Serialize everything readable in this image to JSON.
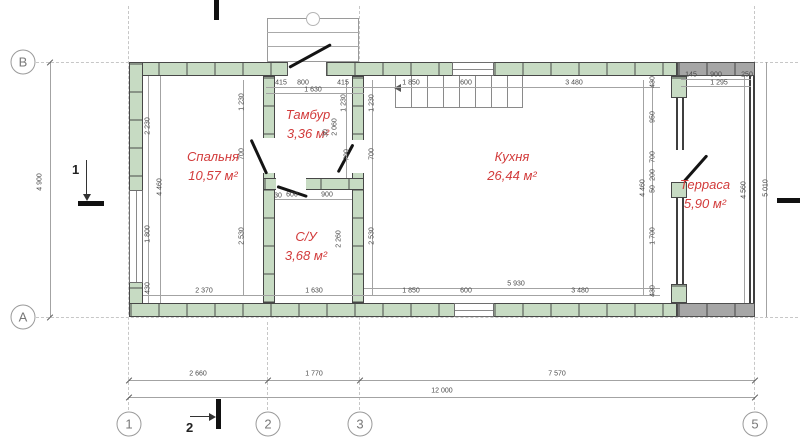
{
  "colors": {
    "wall_fill": "#c7dbc3",
    "terrace_wall_fill": "#a6a6a6",
    "wall_outline": "#474747",
    "room_label": "#d23b3b",
    "dimension_text": "#4a4a4a",
    "grid_line": "#c7c7c7"
  },
  "rooms": [
    {
      "id": "bedroom",
      "name": "Спальня",
      "area": "10,57 м²",
      "x": 213,
      "y": 148
    },
    {
      "id": "vestibule",
      "name": "Тамбур",
      "area": "3,36 м²",
      "x": 308,
      "y": 106
    },
    {
      "id": "bathroom",
      "name": "С/У",
      "area": "3,68 м²",
      "x": 306,
      "y": 228
    },
    {
      "id": "kitchen",
      "name": "Кухня",
      "area": "26,44 м²",
      "x": 512,
      "y": 148
    },
    {
      "id": "terrace",
      "name": "Терраса",
      "area": "5,90 м²",
      "x": 705,
      "y": 176
    }
  ],
  "grid": {
    "columns": [
      {
        "label": "1",
        "x": 129,
        "y": 424
      },
      {
        "label": "2",
        "x": 268,
        "y": 424
      },
      {
        "label": "3",
        "x": 360,
        "y": 424
      },
      {
        "label": "5",
        "x": 755,
        "y": 424
      }
    ],
    "rows": [
      {
        "label": "В",
        "x": 23,
        "y": 62
      },
      {
        "label": "А",
        "x": 23,
        "y": 317
      }
    ]
  },
  "sections": {
    "left_label": "1",
    "bottom_label": "2"
  },
  "dimensions": [
    {
      "t": "415",
      "x": 281,
      "y": 83
    },
    {
      "t": "800",
      "x": 303,
      "y": 83
    },
    {
      "t": "415",
      "x": 343,
      "y": 83
    },
    {
      "t": "1 630",
      "x": 313,
      "y": 90
    },
    {
      "t": "1 850",
      "x": 411,
      "y": 83
    },
    {
      "t": "600",
      "x": 466,
      "y": 83
    },
    {
      "t": "3 480",
      "x": 574,
      "y": 83
    },
    {
      "t": "145",
      "x": 691,
      "y": 75
    },
    {
      "t": "900",
      "x": 716,
      "y": 75
    },
    {
      "t": "250",
      "x": 747,
      "y": 75
    },
    {
      "t": "1 295",
      "x": 719,
      "y": 83
    },
    {
      "t": "4 900",
      "x": 40,
      "y": 182,
      "r": 1
    },
    {
      "t": "2 230",
      "x": 148,
      "y": 126,
      "r": 1
    },
    {
      "t": "1 800",
      "x": 148,
      "y": 234,
      "r": 1
    },
    {
      "t": "430",
      "x": 148,
      "y": 288,
      "r": 1
    },
    {
      "t": "4 460",
      "x": 160,
      "y": 187,
      "r": 1
    },
    {
      "t": "1 230",
      "x": 242,
      "y": 102,
      "r": 1
    },
    {
      "t": "700",
      "x": 242,
      "y": 154,
      "r": 1
    },
    {
      "t": "2 530",
      "x": 242,
      "y": 236,
      "r": 1
    },
    {
      "t": "1 230",
      "x": 344,
      "y": 103,
      "r": 1
    },
    {
      "t": "700",
      "x": 347,
      "y": 155,
      "r": 1
    },
    {
      "t": "2 060",
      "x": 335,
      "y": 127,
      "r": 1
    },
    {
      "t": "30",
      "x": 326,
      "y": 133,
      "r": 1
    },
    {
      "t": "30",
      "x": 278,
      "y": 196
    },
    {
      "t": "600",
      "x": 292,
      "y": 195
    },
    {
      "t": "900",
      "x": 327,
      "y": 195
    },
    {
      "t": "2 260",
      "x": 339,
      "y": 239,
      "r": 1
    },
    {
      "t": "1 230",
      "x": 372,
      "y": 103,
      "r": 1
    },
    {
      "t": "700",
      "x": 372,
      "y": 154,
      "r": 1
    },
    {
      "t": "2 530",
      "x": 372,
      "y": 236,
      "r": 1
    },
    {
      "t": "430",
      "x": 653,
      "y": 82,
      "r": 1
    },
    {
      "t": "950",
      "x": 653,
      "y": 117,
      "r": 1
    },
    {
      "t": "700",
      "x": 653,
      "y": 157,
      "r": 1
    },
    {
      "t": "200",
      "x": 653,
      "y": 175,
      "r": 1
    },
    {
      "t": "50",
      "x": 653,
      "y": 189,
      "r": 1
    },
    {
      "t": "1 700",
      "x": 653,
      "y": 236,
      "r": 1
    },
    {
      "t": "430",
      "x": 653,
      "y": 291,
      "r": 1
    },
    {
      "t": "4 460",
      "x": 643,
      "y": 188,
      "r": 1
    },
    {
      "t": "4 560",
      "x": 744,
      "y": 190,
      "r": 1
    },
    {
      "t": "5 010",
      "x": 766,
      "y": 188,
      "r": 1
    },
    {
      "t": "2 370",
      "x": 204,
      "y": 291
    },
    {
      "t": "1 630",
      "x": 314,
      "y": 291
    },
    {
      "t": "1 850",
      "x": 411,
      "y": 291
    },
    {
      "t": "600",
      "x": 466,
      "y": 291
    },
    {
      "t": "5 930",
      "x": 516,
      "y": 284
    },
    {
      "t": "3 480",
      "x": 580,
      "y": 291
    },
    {
      "t": "2 660",
      "x": 198,
      "y": 374
    },
    {
      "t": "1 770",
      "x": 314,
      "y": 374
    },
    {
      "t": "7 570",
      "x": 557,
      "y": 374
    },
    {
      "t": "12 000",
      "x": 442,
      "y": 391
    }
  ]
}
